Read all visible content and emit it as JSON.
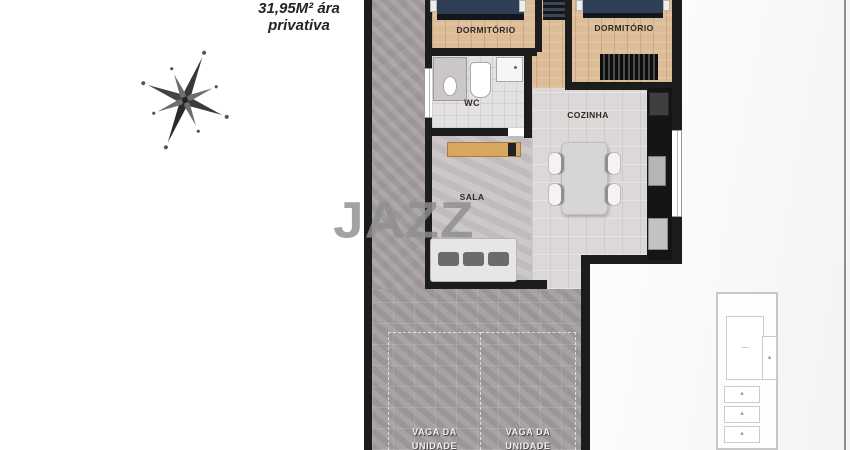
{
  "title": {
    "line1": "31,95M² ára",
    "line2": "privativa"
  },
  "watermark": {
    "text": "JAZZ"
  },
  "compass": {
    "icon": "compass-rose-icon",
    "north_letter": "N"
  },
  "rooms": {
    "bedroom_left": {
      "label": "DORMITÓRIO"
    },
    "bedroom_right": {
      "label": "DORMITÓRIO"
    },
    "wc": {
      "label": "WC"
    },
    "kitchen": {
      "label": "COZINHA"
    },
    "living_room": {
      "label": "SALA"
    }
  },
  "parking": {
    "stall_left": {
      "line1": "VAGA DA",
      "line2": "UNIDADE"
    },
    "stall_right": {
      "line1": "VAGA DA",
      "line2": "UNIDADE"
    }
  },
  "palette": {
    "wall": "#1c1c1c",
    "wood_floor": "#dcbd97",
    "concrete": "#a8a2a4",
    "paving": "#a49da0",
    "kitchen_floor": "#dcd8d8",
    "living_floor": "#c8c3c4",
    "bed_blanket": "#2e3e54",
    "counter": "#151515",
    "sideboard": "#d9a55f",
    "watermark_gray": "#8f8f8f"
  }
}
